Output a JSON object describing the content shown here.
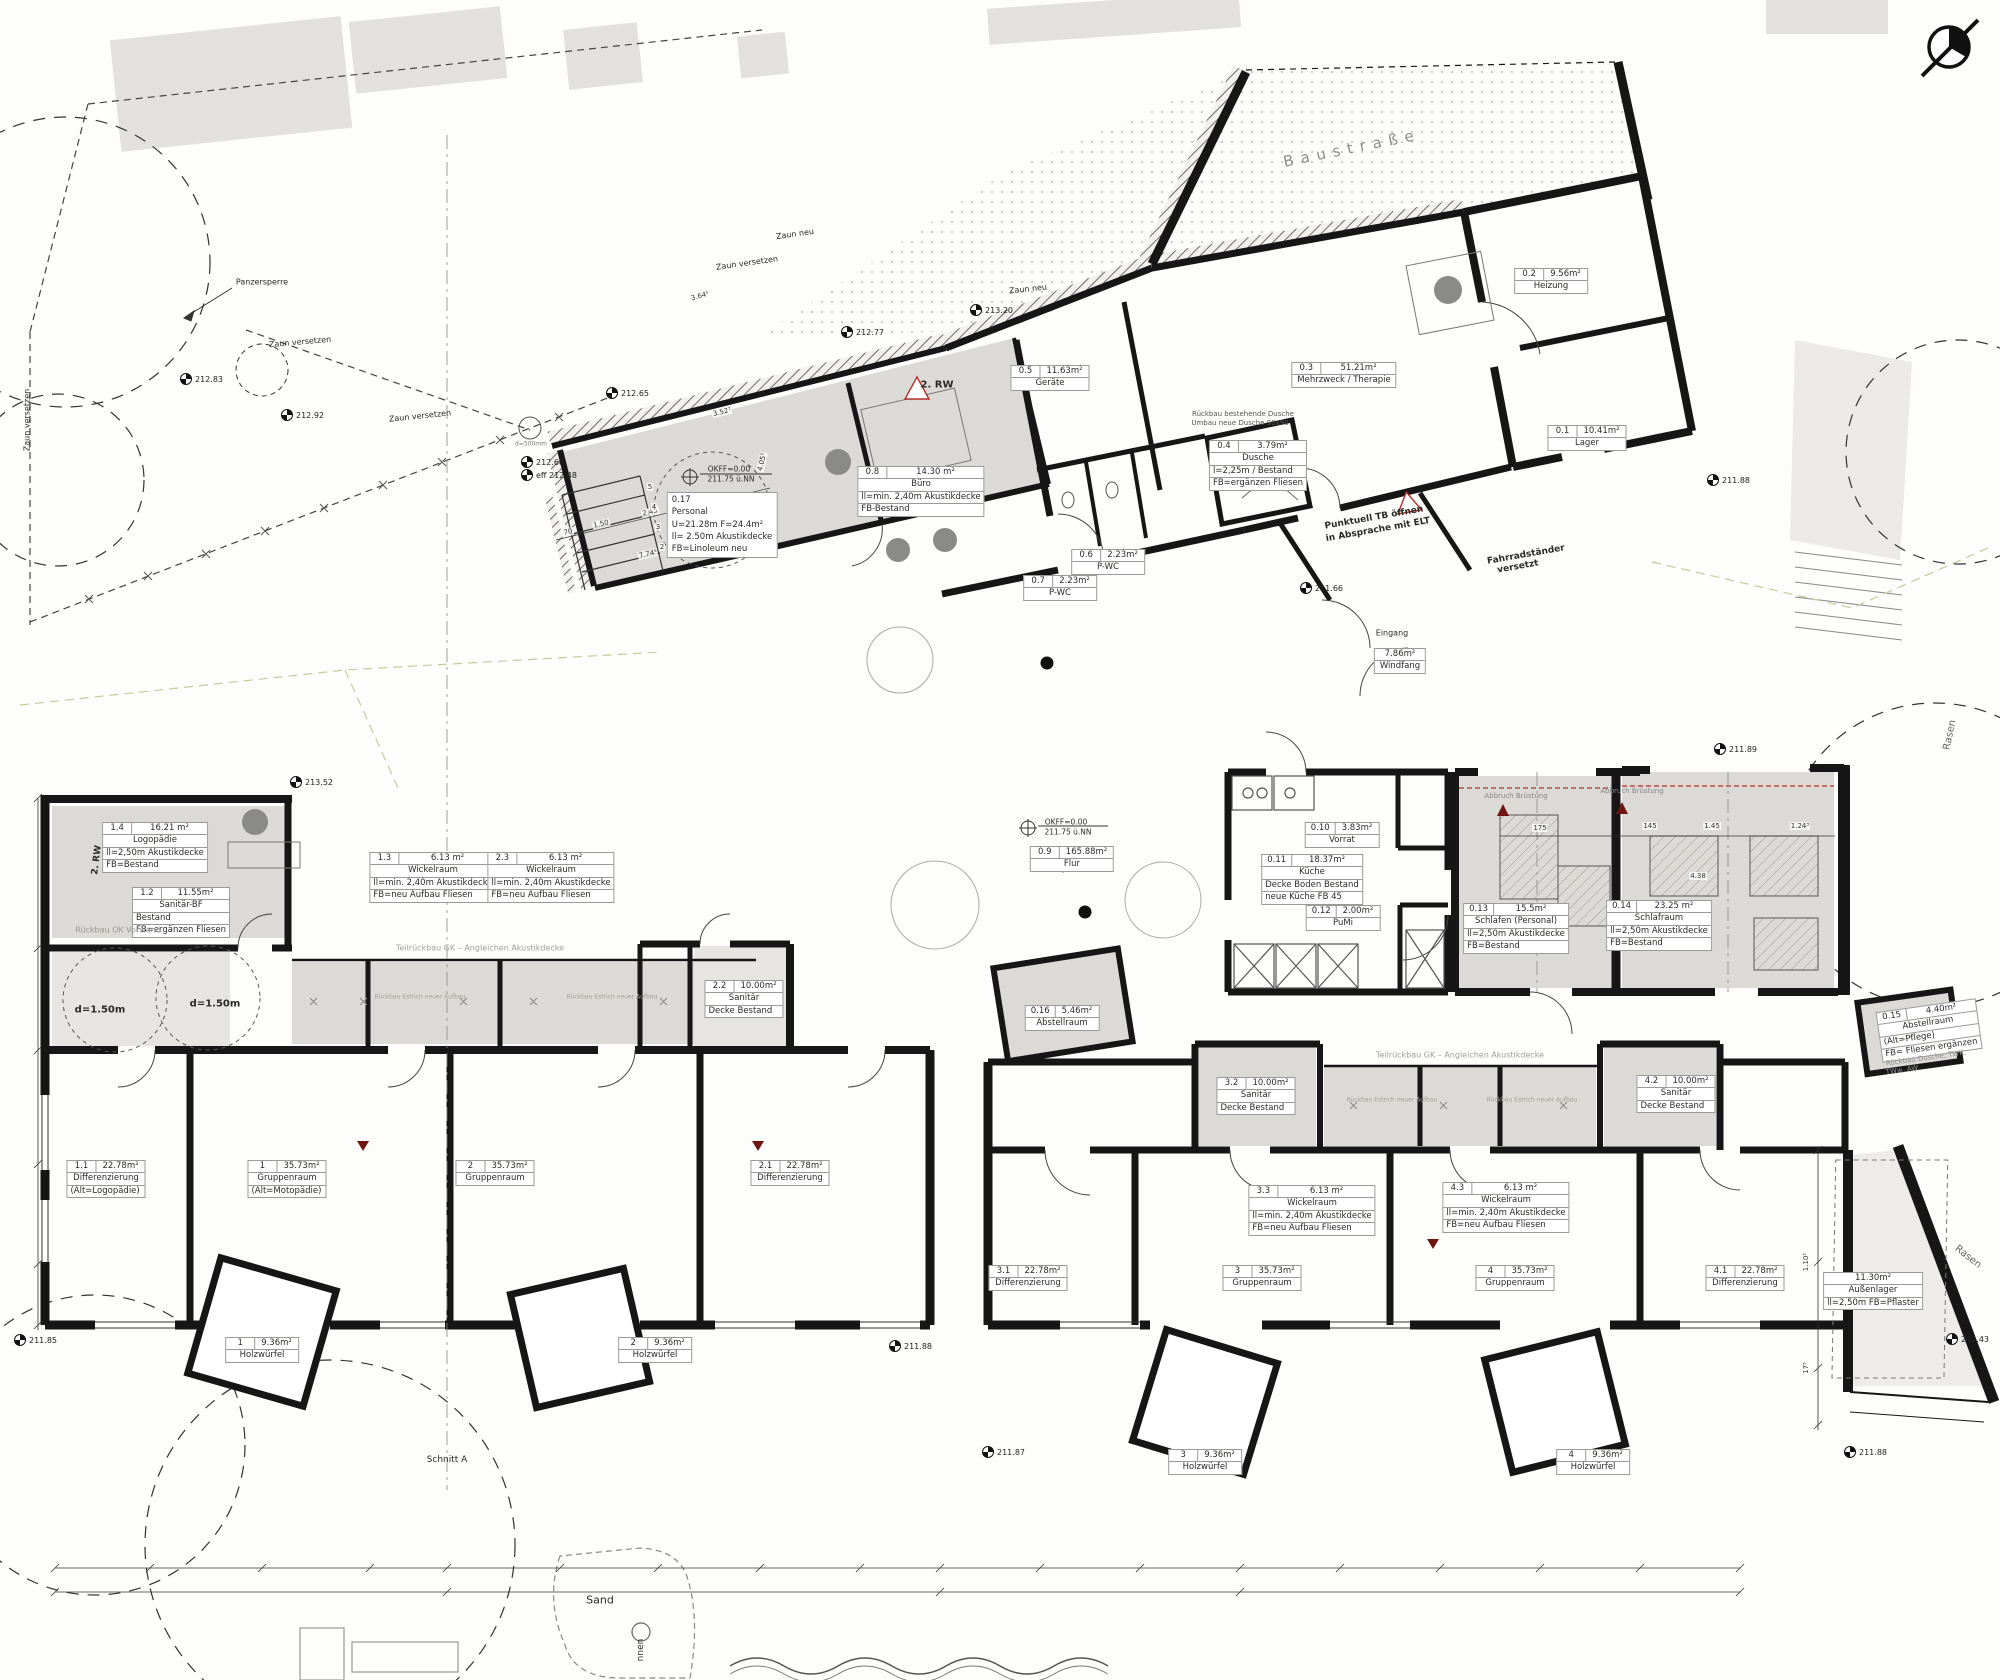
{
  "colors": {
    "wall": "#161616",
    "room_fill": "#dbdad6",
    "room_fill_light": "#e6e5e1",
    "neighbor_fill": "#e2e1dd",
    "accent_red": "#b03026",
    "dark_red": "#6e1511",
    "olive_boundary": "#c9c99c"
  },
  "rooms": [
    {
      "plain": true,
      "lines": [
        "0.17",
        "Personal",
        "U=21.28m  F=24.4m²",
        "ll= 2.50m Akustikdecke",
        "FB=Linoleum neu"
      ],
      "x": 722,
      "y": 492
    },
    {
      "id": "0.8",
      "area": "14.30 m²",
      "name": "Büro",
      "lines": [
        "ll=min. 2,40m Akustikdecke",
        "FB-Bestand"
      ],
      "x": 921,
      "y": 466
    },
    {
      "id": "0.5",
      "area": "11.63m²",
      "name": "Geräte",
      "x": 1050,
      "y": 365
    },
    {
      "id": "0.3",
      "area": "51.21m²",
      "name": "Mehrzweck / Therapie",
      "x": 1344,
      "y": 362
    },
    {
      "id": "0.2",
      "area": "9.56m²",
      "name": "Heizung",
      "x": 1551,
      "y": 268
    },
    {
      "id": "0.1",
      "area": "10.41m²",
      "name": "Lager",
      "x": 1587,
      "y": 425
    },
    {
      "id": "0.4",
      "area": "3.79m²",
      "name": "Dusche",
      "lines": [
        "l=2,25m / Bestand",
        "FB=ergänzen Fliesen"
      ],
      "x": 1258,
      "y": 440
    },
    {
      "id": "0.6",
      "area": "2.23m²",
      "name": "P-WC",
      "x": 1108,
      "y": 549
    },
    {
      "id": "0.7",
      "area": "2.23m²",
      "name": "P-WC",
      "x": 1060,
      "y": 575
    },
    {
      "id": "",
      "area": "7.86m²",
      "name": "Windfang",
      "x": 1400,
      "y": 648
    },
    {
      "id": "0.9",
      "area": "165.88m²",
      "name": "Flur",
      "x": 1072,
      "y": 846
    },
    {
      "id": "0.10",
      "area": "3.83m²",
      "name": "Vorrat",
      "x": 1342,
      "y": 822
    },
    {
      "id": "0.11",
      "area": "18.37m²",
      "name": "Küche",
      "lines": [
        "Decke Boden Bestand",
        "neue Küche FB 45"
      ],
      "x": 1312,
      "y": 854
    },
    {
      "id": "0.12",
      "area": "2.00m²",
      "name": "PuMi",
      "x": 1343,
      "y": 905
    },
    {
      "id": "0.13",
      "area": "15.5m²",
      "name": "Schlafen (Personal)",
      "lines": [
        "ll=2,50m Akustikdecke",
        "FB=Bestand"
      ],
      "x": 1516,
      "y": 903
    },
    {
      "id": "0.14",
      "area": "23.25 m²",
      "name": "Schlafraum",
      "lines": [
        "ll=2,50m Akustikdecke",
        "FB=Bestand"
      ],
      "x": 1659,
      "y": 900
    },
    {
      "id": "1.4",
      "area": "16.21 m²",
      "name": "Logopädie",
      "lines": [
        "ll=2,50m Akustikdecke",
        "FB=Bestand"
      ],
      "x": 155,
      "y": 822
    },
    {
      "id": "1.2",
      "area": "11.55m²",
      "name": "Sanitär-BF",
      "lines": [
        "Bestand",
        "FB=ergänzen Fliesen"
      ],
      "x": 181,
      "y": 887
    },
    {
      "id": "1.3",
      "area": "6.13 m²",
      "name": "Wickelraum",
      "lines": [
        "ll=min. 2,40m Akustikdecke",
        "FB=neu Aufbau Fliesen"
      ],
      "x": 433,
      "y": 852
    },
    {
      "id": "2.3",
      "area": "6.13 m²",
      "name": "Wickelraum",
      "lines": [
        "ll=min. 2,40m Akustikdecke",
        "FB=neu Aufbau Fliesen"
      ],
      "x": 551,
      "y": 852
    },
    {
      "id": "2.2",
      "area": "10.00m²",
      "name": "Sanitär",
      "lines": [
        "Decke Bestand"
      ],
      "x": 744,
      "y": 980
    },
    {
      "id": "1.1",
      "area": "22.78m²",
      "name": "Differenzierung",
      "lines": [
        "(Alt=Logopädie)"
      ],
      "x": 106,
      "y": 1160
    },
    {
      "id": "1",
      "area": "35.73m²",
      "name": "Gruppenraum",
      "lines": [
        "(Alt=Motopädie)"
      ],
      "x": 287,
      "y": 1160
    },
    {
      "id": "2",
      "area": "35.73m²",
      "name": "Gruppenraum",
      "x": 495,
      "y": 1160
    },
    {
      "id": "2.1",
      "area": "22.78m²",
      "name": "Differenzierung",
      "x": 790,
      "y": 1160
    },
    {
      "id": "1",
      "area": "9.36m²",
      "name": "Holzwürfel",
      "x": 262,
      "y": 1337
    },
    {
      "id": "2",
      "area": "9.36m²",
      "name": "Holzwürfel",
      "x": 655,
      "y": 1337
    },
    {
      "id": "0.16",
      "area": "5.46m²",
      "name": "Abstellraum",
      "x": 1062,
      "y": 1005
    },
    {
      "id": "3.2",
      "area": "10.00m²",
      "name": "Sanitär",
      "lines": [
        "Decke Bestand"
      ],
      "x": 1256,
      "y": 1077
    },
    {
      "id": "4.2",
      "area": "10.00m²",
      "name": "Sanitär",
      "lines": [
        "Decke Bestand"
      ],
      "x": 1676,
      "y": 1075
    },
    {
      "id": "3.3",
      "area": "6.13 m²",
      "name": "Wickelraum",
      "lines": [
        "ll=min. 2,40m Akustikdecke",
        "FB=neu Aufbau Fliesen"
      ],
      "x": 1312,
      "y": 1185
    },
    {
      "id": "4.3",
      "area": "6.13 m²",
      "name": "Wickelraum",
      "lines": [
        "ll=min. 2,40m Akustikdecke",
        "FB=neu Aufbau Fliesen"
      ],
      "x": 1506,
      "y": 1182
    },
    {
      "id": "3.1",
      "area": "22.78m²",
      "name": "Differenzierung",
      "x": 1028,
      "y": 1265
    },
    {
      "id": "3",
      "area": "35.73m²",
      "name": "Gruppenraum",
      "x": 1262,
      "y": 1265
    },
    {
      "id": "4",
      "area": "35.73m²",
      "name": "Gruppenraum",
      "x": 1515,
      "y": 1265
    },
    {
      "id": "4.1",
      "area": "22.78m²",
      "name": "Differenzierung",
      "x": 1745,
      "y": 1265
    },
    {
      "id": "3",
      "area": "9.36m²",
      "name": "Holzwürfel",
      "x": 1205,
      "y": 1449
    },
    {
      "id": "4",
      "area": "9.36m²",
      "name": "Holzwürfel",
      "x": 1593,
      "y": 1449
    },
    {
      "id": "0.15",
      "area": "4.40m²",
      "name": "Abstellraum",
      "lines": [
        "(Alt=Pflege)",
        "FB= Fliesen ergänzen"
      ],
      "x": 1929,
      "y": 1005,
      "rot": -8
    },
    {
      "id": "",
      "area": "11.30m²",
      "name": "Außenlager",
      "lines": [
        "ll=2,50m FB=Pflaster"
      ],
      "x": 1873,
      "y": 1272
    }
  ],
  "annotations": [
    {
      "t": "Baustraße",
      "x": 1352,
      "y": 148,
      "r": -11.5,
      "s": 15,
      "c": "#8d8d88",
      "sp": 7
    },
    {
      "t": "Zaun versetzen",
      "x": 747,
      "y": 263,
      "r": -8
    },
    {
      "t": "Zaun neu",
      "x": 795,
      "y": 234,
      "r": -8
    },
    {
      "t": "Zaun neu",
      "x": 1028,
      "y": 289,
      "r": -6
    },
    {
      "t": "Zaun versetzen",
      "x": 300,
      "y": 342,
      "r": -5
    },
    {
      "t": "Zaun versetzen",
      "x": 420,
      "y": 416,
      "r": -6
    },
    {
      "t": "Zaun versetzen",
      "x": 27,
      "y": 420,
      "r": -90
    },
    {
      "t": "Panzersperre",
      "x": 262,
      "y": 282,
      "r": 0
    },
    {
      "t": "2. RW",
      "x": 937,
      "y": 385,
      "r": 0,
      "s": 10,
      "w": "bold"
    },
    {
      "t": "2. RW",
      "x": 97,
      "y": 860,
      "r": -83,
      "s": 9,
      "w": "bold"
    },
    {
      "t": "Rückbau bestehende Dusche",
      "x": 1243,
      "y": 414,
      "r": 0,
      "s": 7,
      "c": "#555"
    },
    {
      "t": "Umbau neue Dusche 90x90",
      "x": 1240,
      "y": 423,
      "r": 0,
      "s": 7,
      "c": "#555"
    },
    {
      "t": "Punktuell TB öffnen",
      "x": 1374,
      "y": 518,
      "r": -10,
      "s": 9,
      "w": "600"
    },
    {
      "t": "in Absprache mit ELT",
      "x": 1378,
      "y": 530,
      "r": -10,
      "s": 9,
      "w": "600"
    },
    {
      "t": "Fahrradständer",
      "x": 1526,
      "y": 555,
      "r": -10,
      "s": 9,
      "w": "600"
    },
    {
      "t": "versetzt",
      "x": 1518,
      "y": 567,
      "r": -10,
      "s": 9,
      "w": "600"
    },
    {
      "t": "Eingang",
      "x": 1392,
      "y": 633,
      "r": 0
    },
    {
      "t": "Rückbau OK Vorwand",
      "x": 118,
      "y": 930,
      "r": 0,
      "c": "#979792"
    },
    {
      "t": "Teilrückbau GK – Angleichen Akustikdecke",
      "x": 480,
      "y": 948,
      "r": 0,
      "c": "#a0a09a"
    },
    {
      "t": "Teilrückbau GK – Angleichen Akustikdecke",
      "x": 1460,
      "y": 1055,
      "r": 0,
      "c": "#a0a09a"
    },
    {
      "t": "Rückbau Estrich neuer Aufbau",
      "x": 420,
      "y": 997,
      "r": 0,
      "s": 6,
      "c": "#a0a09a"
    },
    {
      "t": "Rückbau Estrich neuer Aufbau",
      "x": 612,
      "y": 997,
      "r": 0,
      "s": 6,
      "c": "#a0a09a"
    },
    {
      "t": "Rückbau Estrich neuer Aufbau",
      "x": 1392,
      "y": 1100,
      "r": 0,
      "s": 6,
      "c": "#a0a09a"
    },
    {
      "t": "Rückbau Estrich neuer Aufbau",
      "x": 1532,
      "y": 1100,
      "r": 0,
      "s": 6,
      "c": "#a0a09a"
    },
    {
      "t": "Abbruch Brüstung",
      "x": 1516,
      "y": 796,
      "r": 0,
      "s": 7,
      "c": "#88888a"
    },
    {
      "t": "Abbruch Brüstung",
      "x": 1632,
      "y": 791,
      "r": 0,
      "s": 7,
      "c": "#88888a"
    },
    {
      "t": "Rückbau Dusche, TWK,",
      "x": 1926,
      "y": 1058,
      "r": -8,
      "s": 7,
      "c": "#909090"
    },
    {
      "t": "TWw, AW",
      "x": 1902,
      "y": 1070,
      "r": -8,
      "s": 7,
      "c": "#909090"
    },
    {
      "t": "Rasen",
      "x": 1950,
      "y": 735,
      "r": -78,
      "s": 10,
      "c": "#666"
    },
    {
      "t": "Rasen",
      "x": 1968,
      "y": 1257,
      "r": 38,
      "s": 10,
      "c": "#666"
    },
    {
      "t": "Sand",
      "x": 600,
      "y": 1600,
      "r": 0,
      "s": 11
    },
    {
      "t": "nnen",
      "x": 641,
      "y": 1650,
      "r": -90,
      "s": 9
    },
    {
      "t": "d=1.50m",
      "x": 100,
      "y": 1010,
      "r": 0,
      "s": 10,
      "w": "bold"
    },
    {
      "t": "d=1.50m",
      "x": 215,
      "y": 1004,
      "r": 0,
      "s": 10,
      "w": "bold"
    },
    {
      "t": "d=500mm",
      "x": 531,
      "y": 444,
      "r": 0,
      "s": 6,
      "c": "#777"
    },
    {
      "t": "Schnitt A",
      "x": 447,
      "y": 1460,
      "r": 0,
      "s": 9
    },
    {
      "t": "OKFF=0.00",
      "x": 729,
      "y": 469,
      "r": 0,
      "s": 7.5
    },
    {
      "t": "211.75 ü.NN",
      "x": 731,
      "y": 479,
      "r": 0,
      "s": 7.5
    },
    {
      "t": "OKFF=0.00",
      "x": 1066,
      "y": 822,
      "r": 0,
      "s": 7.5
    },
    {
      "t": "211.75 ü.NN",
      "x": 1068,
      "y": 832,
      "r": 0,
      "s": 7.5
    }
  ],
  "elevations": [
    {
      "v": "213.20",
      "x": 970,
      "y": 309
    },
    {
      "v": "212.77",
      "x": 841,
      "y": 331
    },
    {
      "v": "212.65",
      "x": 606,
      "y": 392
    },
    {
      "v": "212.60",
      "x": 521,
      "y": 461
    },
    {
      "v": "eff 212.48",
      "x": 521,
      "y": 474
    },
    {
      "v": "213.52",
      "x": 290,
      "y": 781
    },
    {
      "v": "212.83",
      "x": 180,
      "y": 378
    },
    {
      "v": "212.92",
      "x": 281,
      "y": 414
    },
    {
      "v": "211.66",
      "x": 1300,
      "y": 587
    },
    {
      "v": "211.88",
      "x": 1707,
      "y": 479
    },
    {
      "v": "211.89",
      "x": 1714,
      "y": 748
    },
    {
      "v": "211.85",
      "x": 14,
      "y": 1339
    },
    {
      "v": "211.88",
      "x": 889,
      "y": 1345
    },
    {
      "v": "211.87",
      "x": 982,
      "y": 1451
    },
    {
      "v": "211.88",
      "x": 1844,
      "y": 1451
    },
    {
      "v": "212.43",
      "x": 1946,
      "y": 1338
    }
  ],
  "dims": [
    {
      "t": "3.64⁵",
      "x": 700,
      "y": 296,
      "r": -15
    },
    {
      "t": "3.52⁷",
      "x": 722,
      "y": 412,
      "r": -13
    },
    {
      "t": "4.05⁵",
      "x": 762,
      "y": 462,
      "r": -77
    },
    {
      "t": "70",
      "x": 568,
      "y": 532,
      "r": -13
    },
    {
      "t": "1.50",
      "x": 601,
      "y": 524,
      "r": -13
    },
    {
      "t": "2.45",
      "x": 650,
      "y": 512,
      "r": -13
    },
    {
      "t": "1.43⁵",
      "x": 706,
      "y": 498,
      "r": -13
    },
    {
      "t": "7.74⁵",
      "x": 648,
      "y": 554,
      "r": -13
    },
    {
      "t": "175",
      "x": 1540,
      "y": 828,
      "r": 0
    },
    {
      "t": "145",
      "x": 1650,
      "y": 826,
      "r": 0
    },
    {
      "t": "1.45",
      "x": 1712,
      "y": 826,
      "r": 0
    },
    {
      "t": "1.24³",
      "x": 1800,
      "y": 826,
      "r": 0
    },
    {
      "t": "1.10¹",
      "x": 1806,
      "y": 1262,
      "r": -90
    },
    {
      "t": "17⁵",
      "x": 1806,
      "y": 1368,
      "r": -90
    },
    {
      "t": "5",
      "x": 650,
      "y": 487,
      "r": 0
    },
    {
      "t": "4",
      "x": 654,
      "y": 507,
      "r": 0
    },
    {
      "t": "3",
      "x": 658,
      "y": 527,
      "r": 0
    },
    {
      "t": "2",
      "x": 662,
      "y": 547,
      "r": 0
    },
    {
      "t": "4.38",
      "x": 1698,
      "y": 876,
      "r": 0
    }
  ]
}
